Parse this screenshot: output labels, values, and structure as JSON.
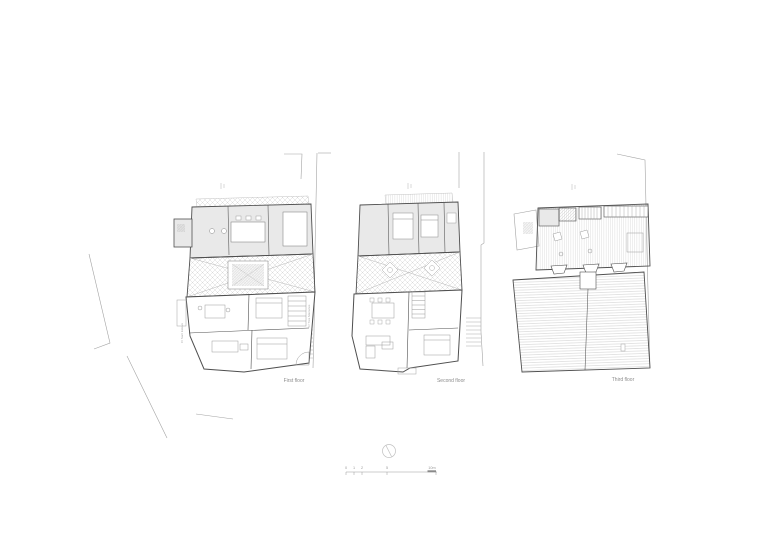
{
  "drawing": {
    "type": "architectural-floor-plans",
    "plans": [
      {
        "label": "First floor"
      },
      {
        "label": "Second floor"
      },
      {
        "label": "Third floor"
      }
    ],
    "street_labels": {
      "left": "C/ Sant Esteve",
      "right": "C/ Tres Marianes"
    },
    "scale_bar": {
      "tick_labels": [
        "0",
        "1",
        "2",
        "5",
        "10m"
      ]
    },
    "colors": {
      "background": "#ffffff",
      "wall_line": "#4f4f4f",
      "context_line": "#a3a3a3",
      "room_fill": "#e9e9e9",
      "hatch_line": "#c9c9c9",
      "label_text": "#8c8c8c"
    }
  }
}
